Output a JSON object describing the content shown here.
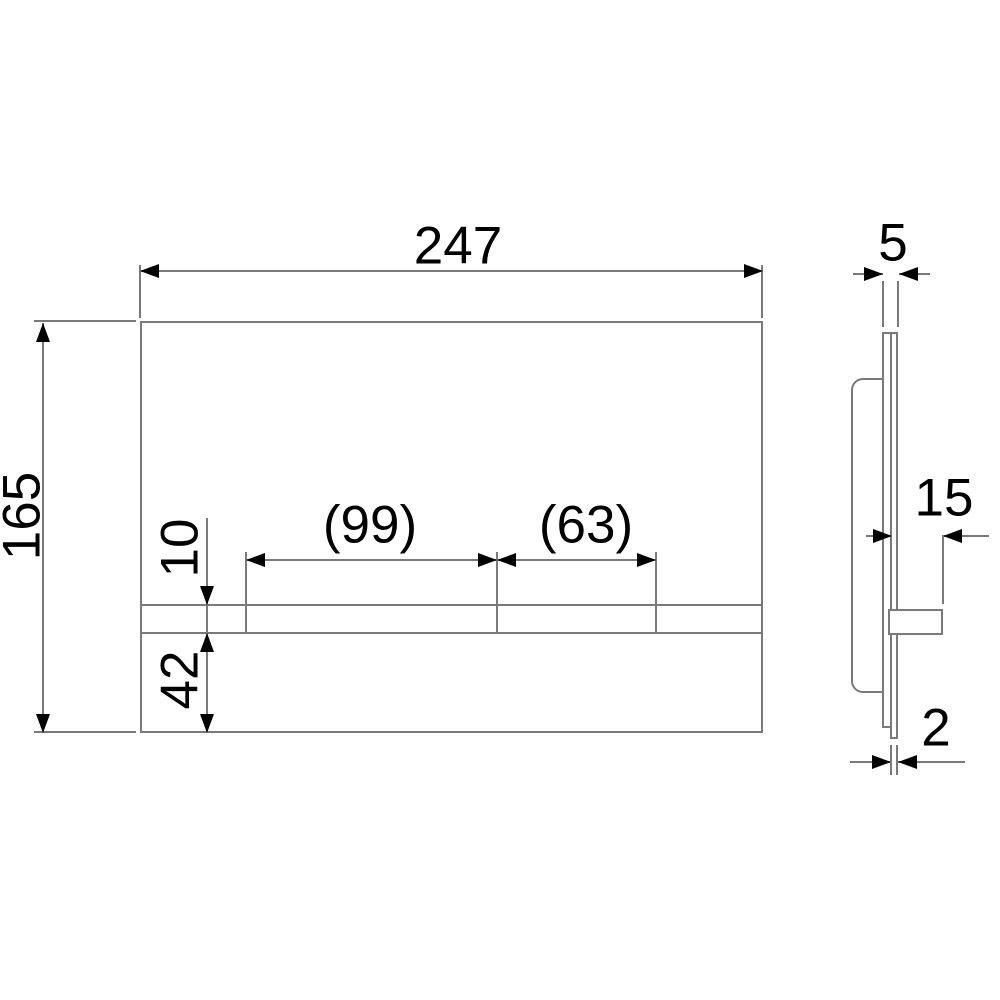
{
  "colors": {
    "line": "#7a7a7a",
    "ink": "#000000",
    "bg": "#ffffff"
  },
  "front_view": {
    "width": "247",
    "height": "165",
    "large_button_width": "(99)",
    "small_button_width": "(63)",
    "strip_height": "10",
    "bottom_offset": "42"
  },
  "side_view": {
    "total_thickness": "5",
    "button_protrusion": "15",
    "panel_thickness": "2"
  }
}
